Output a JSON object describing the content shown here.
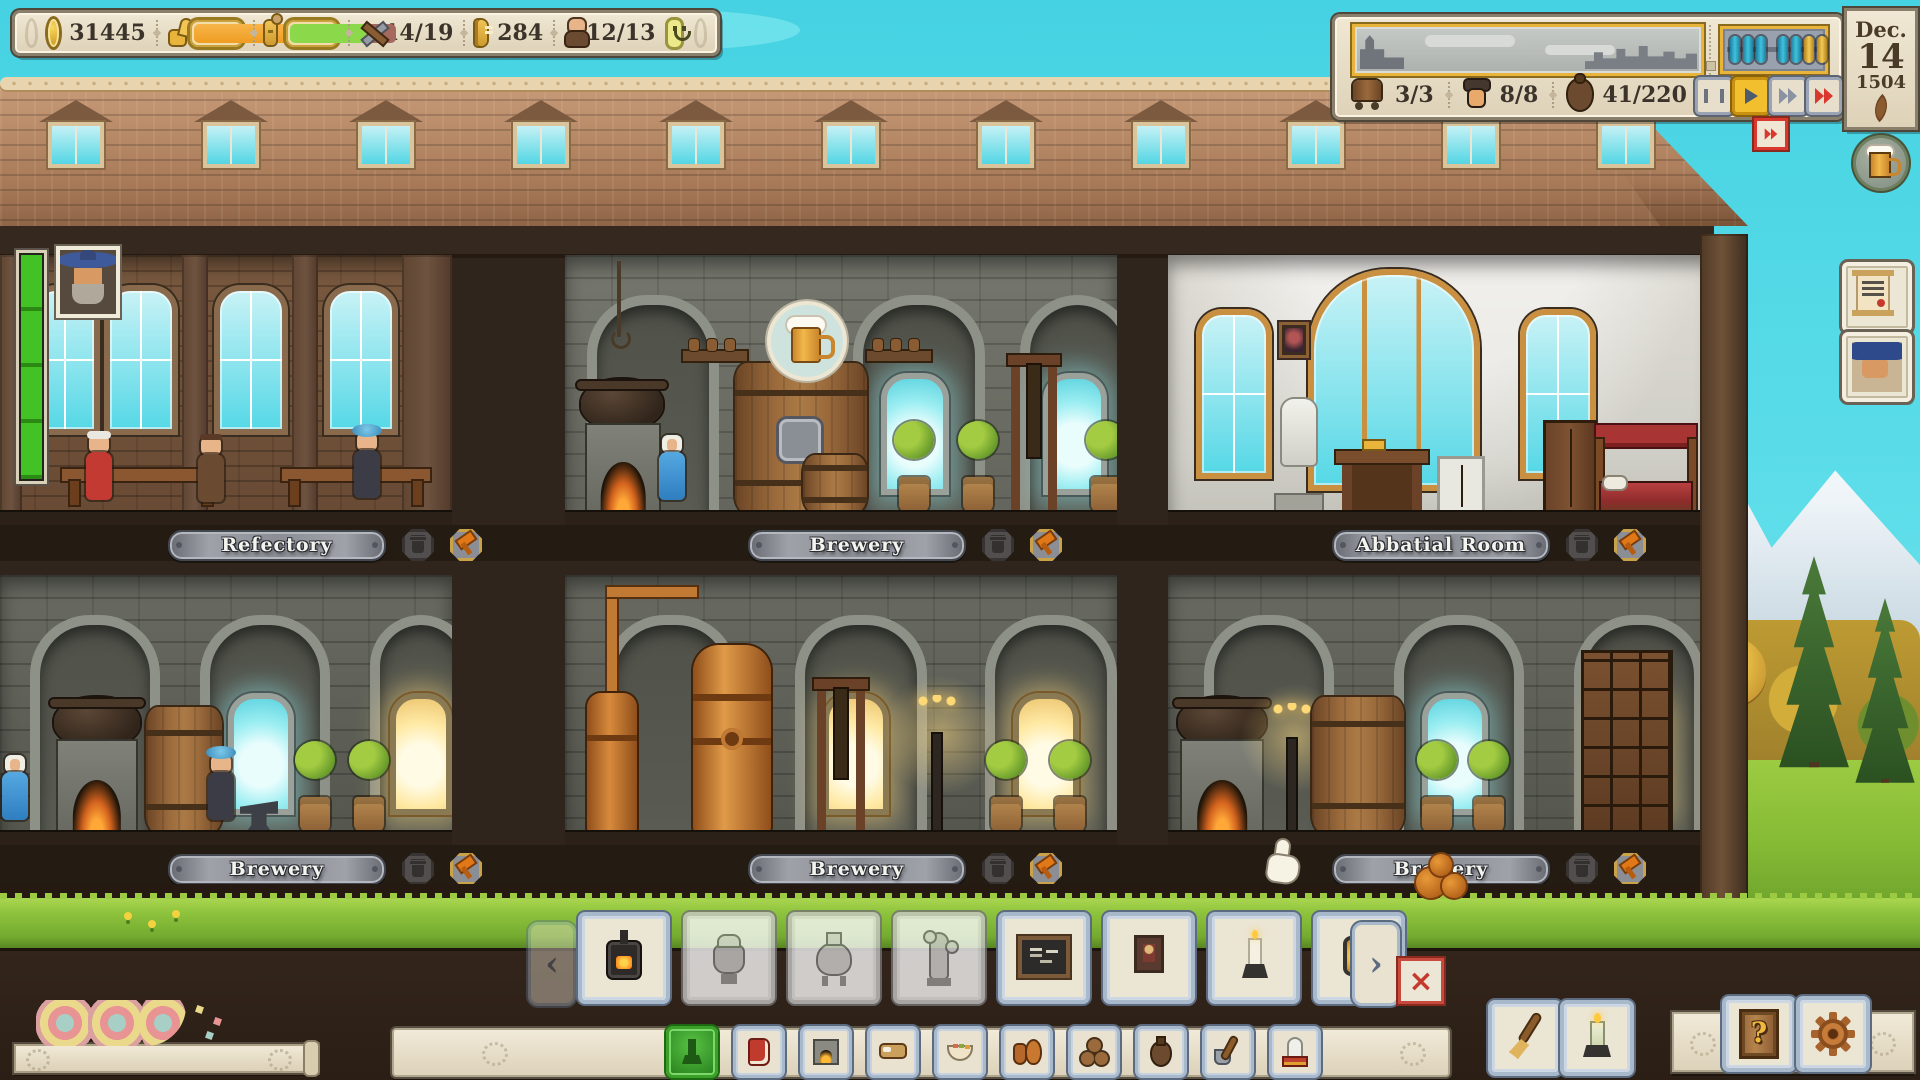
{
  "hud": {
    "coins": "31445",
    "craft": "14/19",
    "ledger": "284",
    "monks": "12/13"
  },
  "logistics": {
    "carts": "3/3",
    "guests": "8/8",
    "storage": "41/220"
  },
  "date": {
    "month": "Dec.",
    "day": "14",
    "year": "1504"
  },
  "rooms": [
    {
      "label": "Refectory"
    },
    {
      "label": "Brewery"
    },
    {
      "label": "Abbatial Room"
    },
    {
      "label": "Brewery"
    },
    {
      "label": "Brewery"
    },
    {
      "label": "Brewery"
    }
  ],
  "abacus": {
    "beads": [
      "teal",
      "teal",
      "teal",
      "teal",
      "teal",
      "gold",
      "gold"
    ]
  },
  "toolbar": {
    "items": [
      {
        "name": "stove",
        "enabled": true
      },
      {
        "name": "mash-tun",
        "enabled": false
      },
      {
        "name": "brew-kettle",
        "enabled": false
      },
      {
        "name": "still-tower",
        "enabled": false
      },
      {
        "name": "blackboard",
        "enabled": true
      },
      {
        "name": "icon-painting",
        "enabled": true
      },
      {
        "name": "candle-holder",
        "enabled": true
      },
      {
        "name": "lantern",
        "enabled": true
      }
    ]
  },
  "menu": {
    "buttons": [
      {
        "name": "furnishings",
        "selected": true
      },
      {
        "name": "library",
        "selected": false
      },
      {
        "name": "kitchen",
        "selected": false
      },
      {
        "name": "dormitory",
        "selected": false
      },
      {
        "name": "food",
        "selected": false
      },
      {
        "name": "brewing",
        "selected": false
      },
      {
        "name": "cellar",
        "selected": false
      },
      {
        "name": "goods",
        "selected": false
      },
      {
        "name": "cleaning",
        "selected": false
      },
      {
        "name": "decorations",
        "selected": false
      }
    ]
  },
  "icons": {
    "prev": "‹",
    "next": "›",
    "close": "×",
    "help": "?"
  },
  "colors": {
    "gold": "#e9b43c",
    "teal_bead": "#3fc2de",
    "red": "#d8382e",
    "quest_green": "#43c226",
    "bar_orange": "#ef9d22",
    "capacity_green": "#8bd84a",
    "selected_green": "#2e8a22",
    "sky": "#5cdde9"
  }
}
